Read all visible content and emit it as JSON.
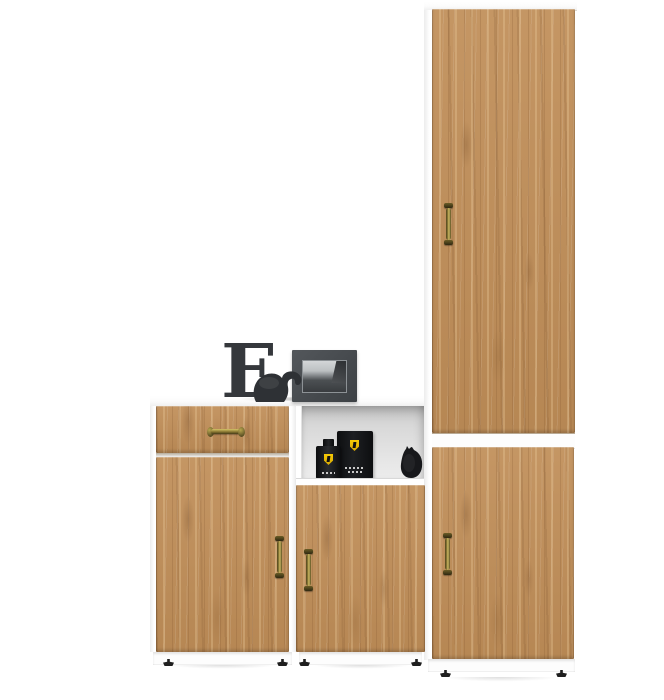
{
  "product": {
    "name": "hallway cabinet set with oak doors",
    "scene_type": "furniture-product-photo",
    "background": "#ffffff"
  },
  "colors": {
    "wood_base": "#c08e58",
    "wood_dark": "#7d5330",
    "wood_light": "#e4b987",
    "carcass_white": "#fdfdfd",
    "niche_interior_gray": "#d9d9d9",
    "handle_brass": "#9c8a3e",
    "handle_brass_dark": "#3c3315",
    "decor_charcoal": "#35383c",
    "photo_sky_gray": "#c7cacc",
    "ferrari_shield_yellow": "#f3c402",
    "item_black": "#17181b",
    "foot_black": "#1f1f1f"
  },
  "units": {
    "tall_cabinet": {
      "label": "tall wardrobe",
      "doors": 2,
      "handles": 2,
      "position": "right"
    },
    "left_chest": {
      "label": "chest with drawer and door",
      "drawers": 1,
      "doors": 1,
      "handles": 2,
      "position": "left"
    },
    "middle_unit": {
      "label": "cabinet with open niche and door",
      "niches": 1,
      "doors": 1,
      "handles": 1,
      "position": "middle"
    }
  },
  "decor": {
    "letter": "E",
    "tabletop_items": [
      "decorative-letter-e",
      "elephant-figurine",
      "black-photo-frame"
    ],
    "niche_items": [
      "black-perfume-bottle",
      "black-perfume-box",
      "black-bird-figurine"
    ],
    "logo_icon": "ferrari-shield-icon"
  },
  "hardware": {
    "handle_style": "antique-brass",
    "vertical_handles": 4,
    "horizontal_handles": 1,
    "visible_feet": 6
  }
}
